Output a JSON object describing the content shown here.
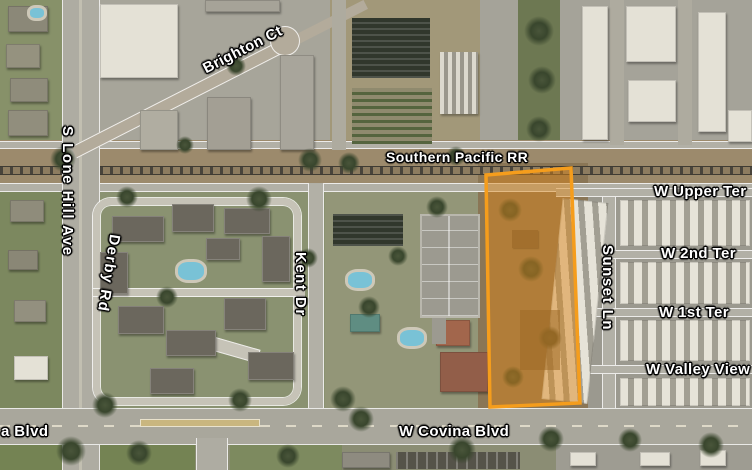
{
  "map": {
    "description": "Aerial satellite imagery with street labels and one parcel highlighted in orange",
    "highlight_parcel": {
      "border_color": "#F59D1C",
      "fill_color": "rgba(219,134,25,0.48)"
    },
    "labels": {
      "brighton_ct": "Brighton Ct",
      "s_lone_hill_ave": "S Lone Hill Ave",
      "derby_rd": "Derby Rd",
      "kent_dr": "Kent Dr",
      "southern_pacific_rr": "Southern Pacific RR",
      "w_upper_ter": "W Upper Ter",
      "w_2nd_ter": "W 2nd Ter",
      "w_1st_ter": "W 1st Ter",
      "sunset_ln": "Sunset Ln",
      "w_valley_view": "W Valley View",
      "w_covina_blvd": "W Covina Blvd",
      "a_blvd": "a Blvd"
    }
  }
}
